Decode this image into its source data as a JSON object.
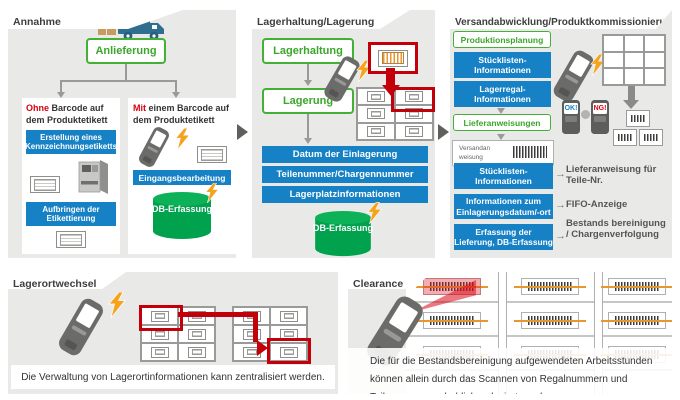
{
  "colors": {
    "accent_blue": "#1681c4",
    "db_green": "#00a24e",
    "outline_green": "#44b035",
    "alert_red": "#d7000f",
    "lightning_orange": "#f5a21d",
    "panel_gray": "#e9e9e7"
  },
  "panel_annahme": {
    "title": "Annahme",
    "anlieferung_label": "Anlieferung",
    "branch_ohne": {
      "em": "Ohne",
      "text": "Barcode auf dem Produktetikett",
      "step1": "Erstellung eines Kennzeichnungsetiketts",
      "step2": "Aufbringen der Etikettierung"
    },
    "branch_mit": {
      "em": "Mit",
      "text": "einem Barcode auf dem Produktetikett",
      "step1": "Eingangsbearbeitung",
      "db_label": "DB-Erfassung"
    }
  },
  "panel_lagerung": {
    "title": "Lagerhaltung/Lagerung",
    "btn_lagerhaltung": "Lagerhaltung",
    "btn_lagerung": "Lagerung",
    "bar1": "Datum der Einlagerung",
    "bar2": "Teilenummer/Chargennummer",
    "bar3": "Lagerplatzinformationen",
    "db_label": "DB-Erfassung"
  },
  "panel_versand": {
    "title": "Versandabwicklung/Produktkommissionierung",
    "btn_produktionsplanung": "Produktionsplanung",
    "bar_stuecklisten": "Stücklisten-Informationen",
    "bar_lagerregal": "Lagerregal-Informationen",
    "btn_lieferanweisungen": "Lieferanweisungen",
    "paper_line1": "Versandan",
    "paper_line2": "weisung",
    "device_ok": "OK!",
    "device_ng": "NG!",
    "map1_bar": "Stücklisten-Informationen",
    "map1_result": "Lieferanweisung für Teile-Nr.",
    "map2_bar": "Informationen zum Einlagerungsdatum/-ort",
    "map2_result": "FIFO-Anzeige",
    "map3_bar": "Erfassung der Lieferung, DB-Erfassung",
    "map3_result": "Bestands bereinigung / Chargenverfolgung"
  },
  "panel_lagerortwechsel": {
    "title": "Lagerortwechsel",
    "caption": "Die Verwaltung von Lagerortinformationen kann zentralisiert werden."
  },
  "panel_clearance": {
    "title": "Clearance",
    "caption": "Die für die Bestandsbereinigung aufgewendeten Arbeitsstunden können allein durch das Scannen von Regalnummern und Teilenummern erheblich reduziert werden."
  }
}
